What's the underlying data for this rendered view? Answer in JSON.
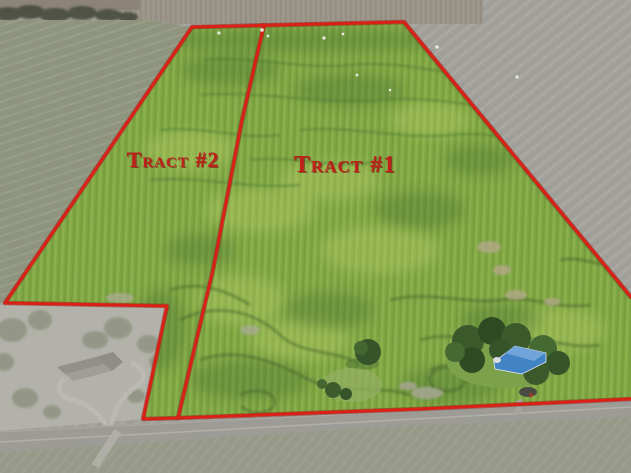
{
  "labels": {
    "tract1": "Tract #1",
    "tract2": "Tract #2"
  },
  "colors": {
    "boundary_red": "#d92118",
    "label_red": "#bf2019",
    "crop_green": "#7ea543",
    "outside_gray": "#a2a09b",
    "road_gray": "#9c9b96",
    "building_roof_blue": "#4183c4"
  }
}
